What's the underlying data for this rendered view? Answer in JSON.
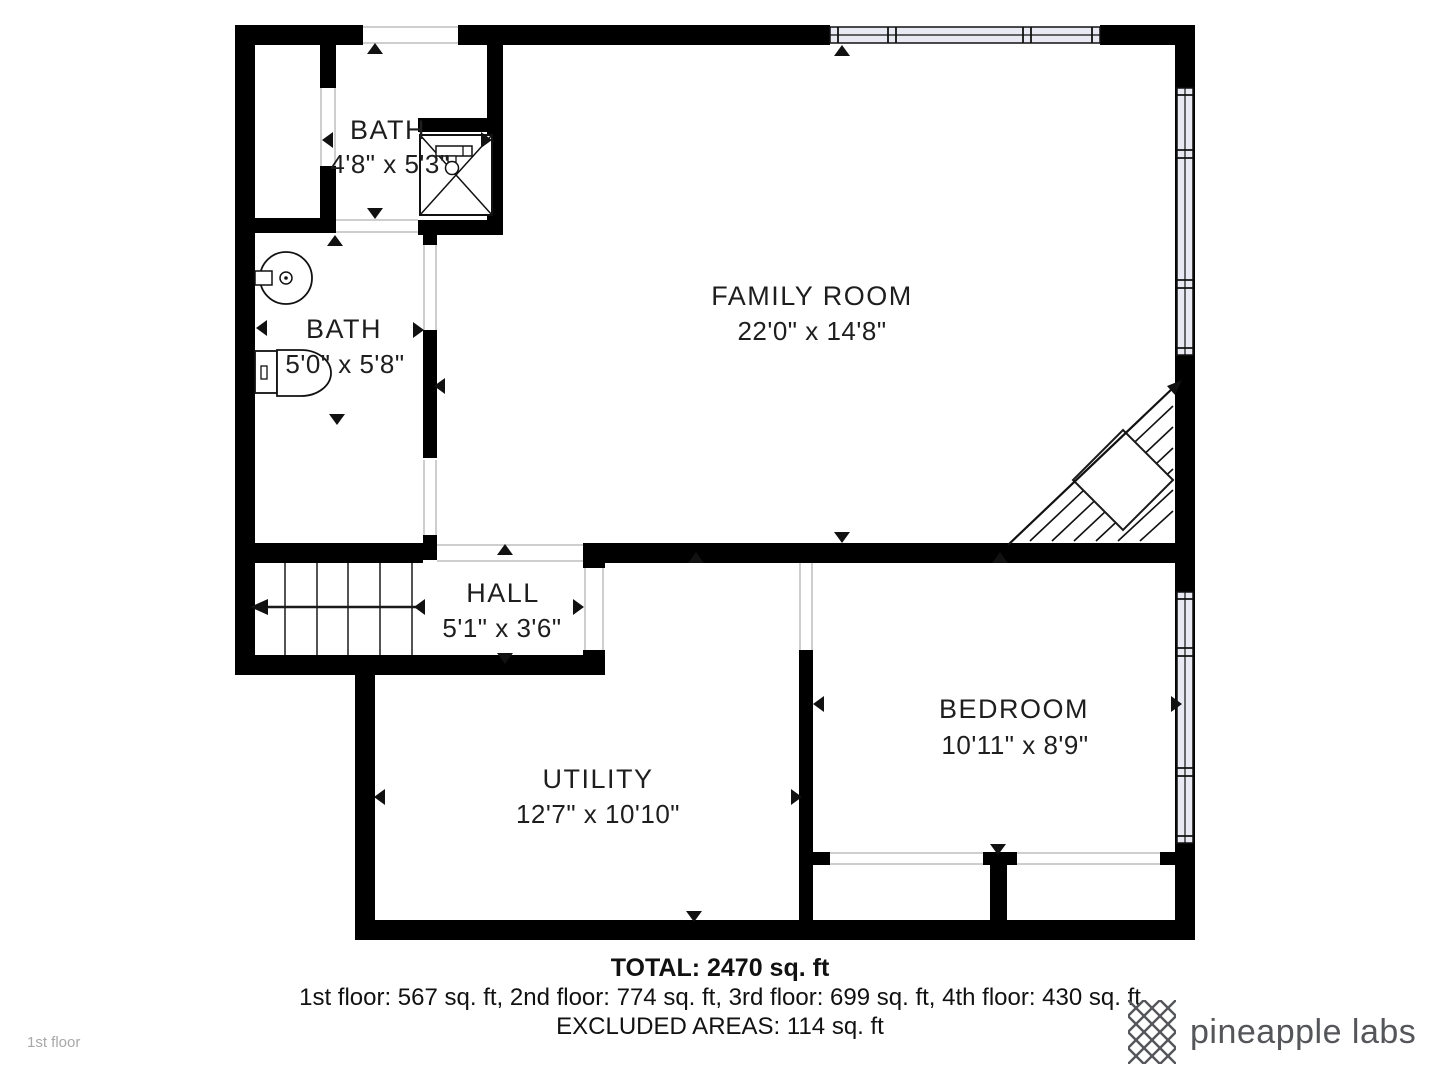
{
  "plan": {
    "floor_label": "1st floor",
    "rooms": [
      {
        "id": "bath-top",
        "name": "BATH",
        "dims": "4'8\" x 5'3\""
      },
      {
        "id": "bath-main",
        "name": "BATH",
        "dims": "5'0\" x 5'8\""
      },
      {
        "id": "family-room",
        "name": "FAMILY ROOM",
        "dims": "22'0\" x 14'8\""
      },
      {
        "id": "hall",
        "name": "HALL",
        "dims": "5'1\" x 3'6\""
      },
      {
        "id": "utility",
        "name": "UTILITY",
        "dims": "12'7\" x 10'10\""
      },
      {
        "id": "bedroom",
        "name": "BEDROOM",
        "dims": "10'11\" x 8'9\""
      }
    ],
    "fixture_icons": [
      "shower-icon",
      "sink-icon",
      "toilet-icon",
      "staircase-icon",
      "winder-staircase-icon",
      "window-icon"
    ]
  },
  "summary": {
    "total": "TOTAL: 2470 sq. ft",
    "floors": "1st floor: 567 sq. ft, 2nd floor: 774 sq. ft, 3rd floor: 699 sq. ft, 4th floor: 430 sq. ft",
    "excluded": "EXCLUDED AREAS: 114 sq. ft"
  },
  "brand": {
    "name": "pineapple labs"
  },
  "colors": {
    "wall": "#000000",
    "window_fill": "#e9e9f4",
    "threshold_line": "#bdbdbd",
    "label_text": "#1e1e1e",
    "brand_text": "#55565a",
    "muted_text": "#a8a8a8"
  }
}
